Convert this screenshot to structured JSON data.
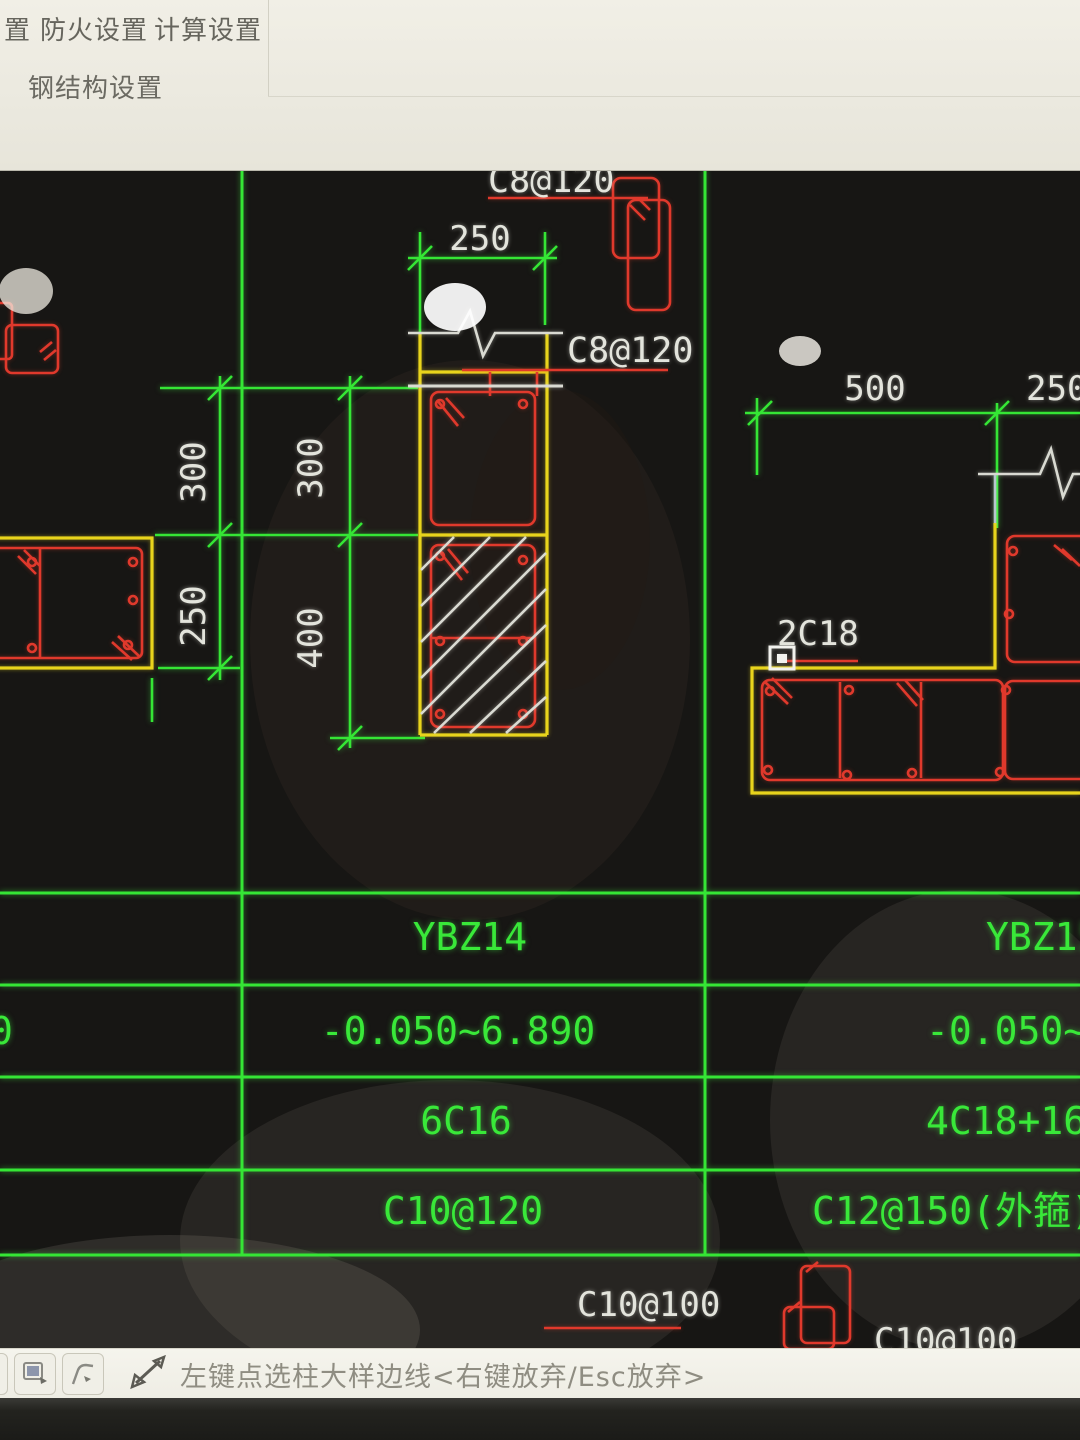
{
  "menu": {
    "items": [
      {
        "label": "置"
      },
      {
        "label": "防火设置"
      },
      {
        "label": "计算设置"
      }
    ],
    "row2_label": "钢结构设置"
  },
  "canvas": {
    "labels": {
      "c8_120_top": "C8@120",
      "c8_120_mid": "C8@120",
      "dim_250_top": "250",
      "dim_300_left": "300",
      "dim_250_left": "250",
      "dim_300_mid": "300",
      "dim_400_mid": "400",
      "dim_500": "500",
      "dim_250_right": "250",
      "rebar_2c18": "2C18",
      "c10_100_left": "C10@100",
      "c10_100_right": "C10@100"
    },
    "table": {
      "left_partial": "0",
      "columns": [
        {
          "name": "YBZ14",
          "elevation": "-0.050~6.890",
          "vertical_rebar": "6C16",
          "stirrup": "C10@120"
        },
        {
          "name": "YBZ15",
          "elevation": "-0.050~6.890",
          "vertical_rebar": "4C18+16C18",
          "stirrup": "C12@150(外箍)+C10@100"
        }
      ]
    }
  },
  "statusbar": {
    "hint": "左键点选柱大样边线<右键放弃/Esc放弃>"
  },
  "colors": {
    "cad_green": "#35e635",
    "cad_red": "#e0392c",
    "cad_yellow": "#e8d41c",
    "cad_white": "#e3e4dc"
  }
}
